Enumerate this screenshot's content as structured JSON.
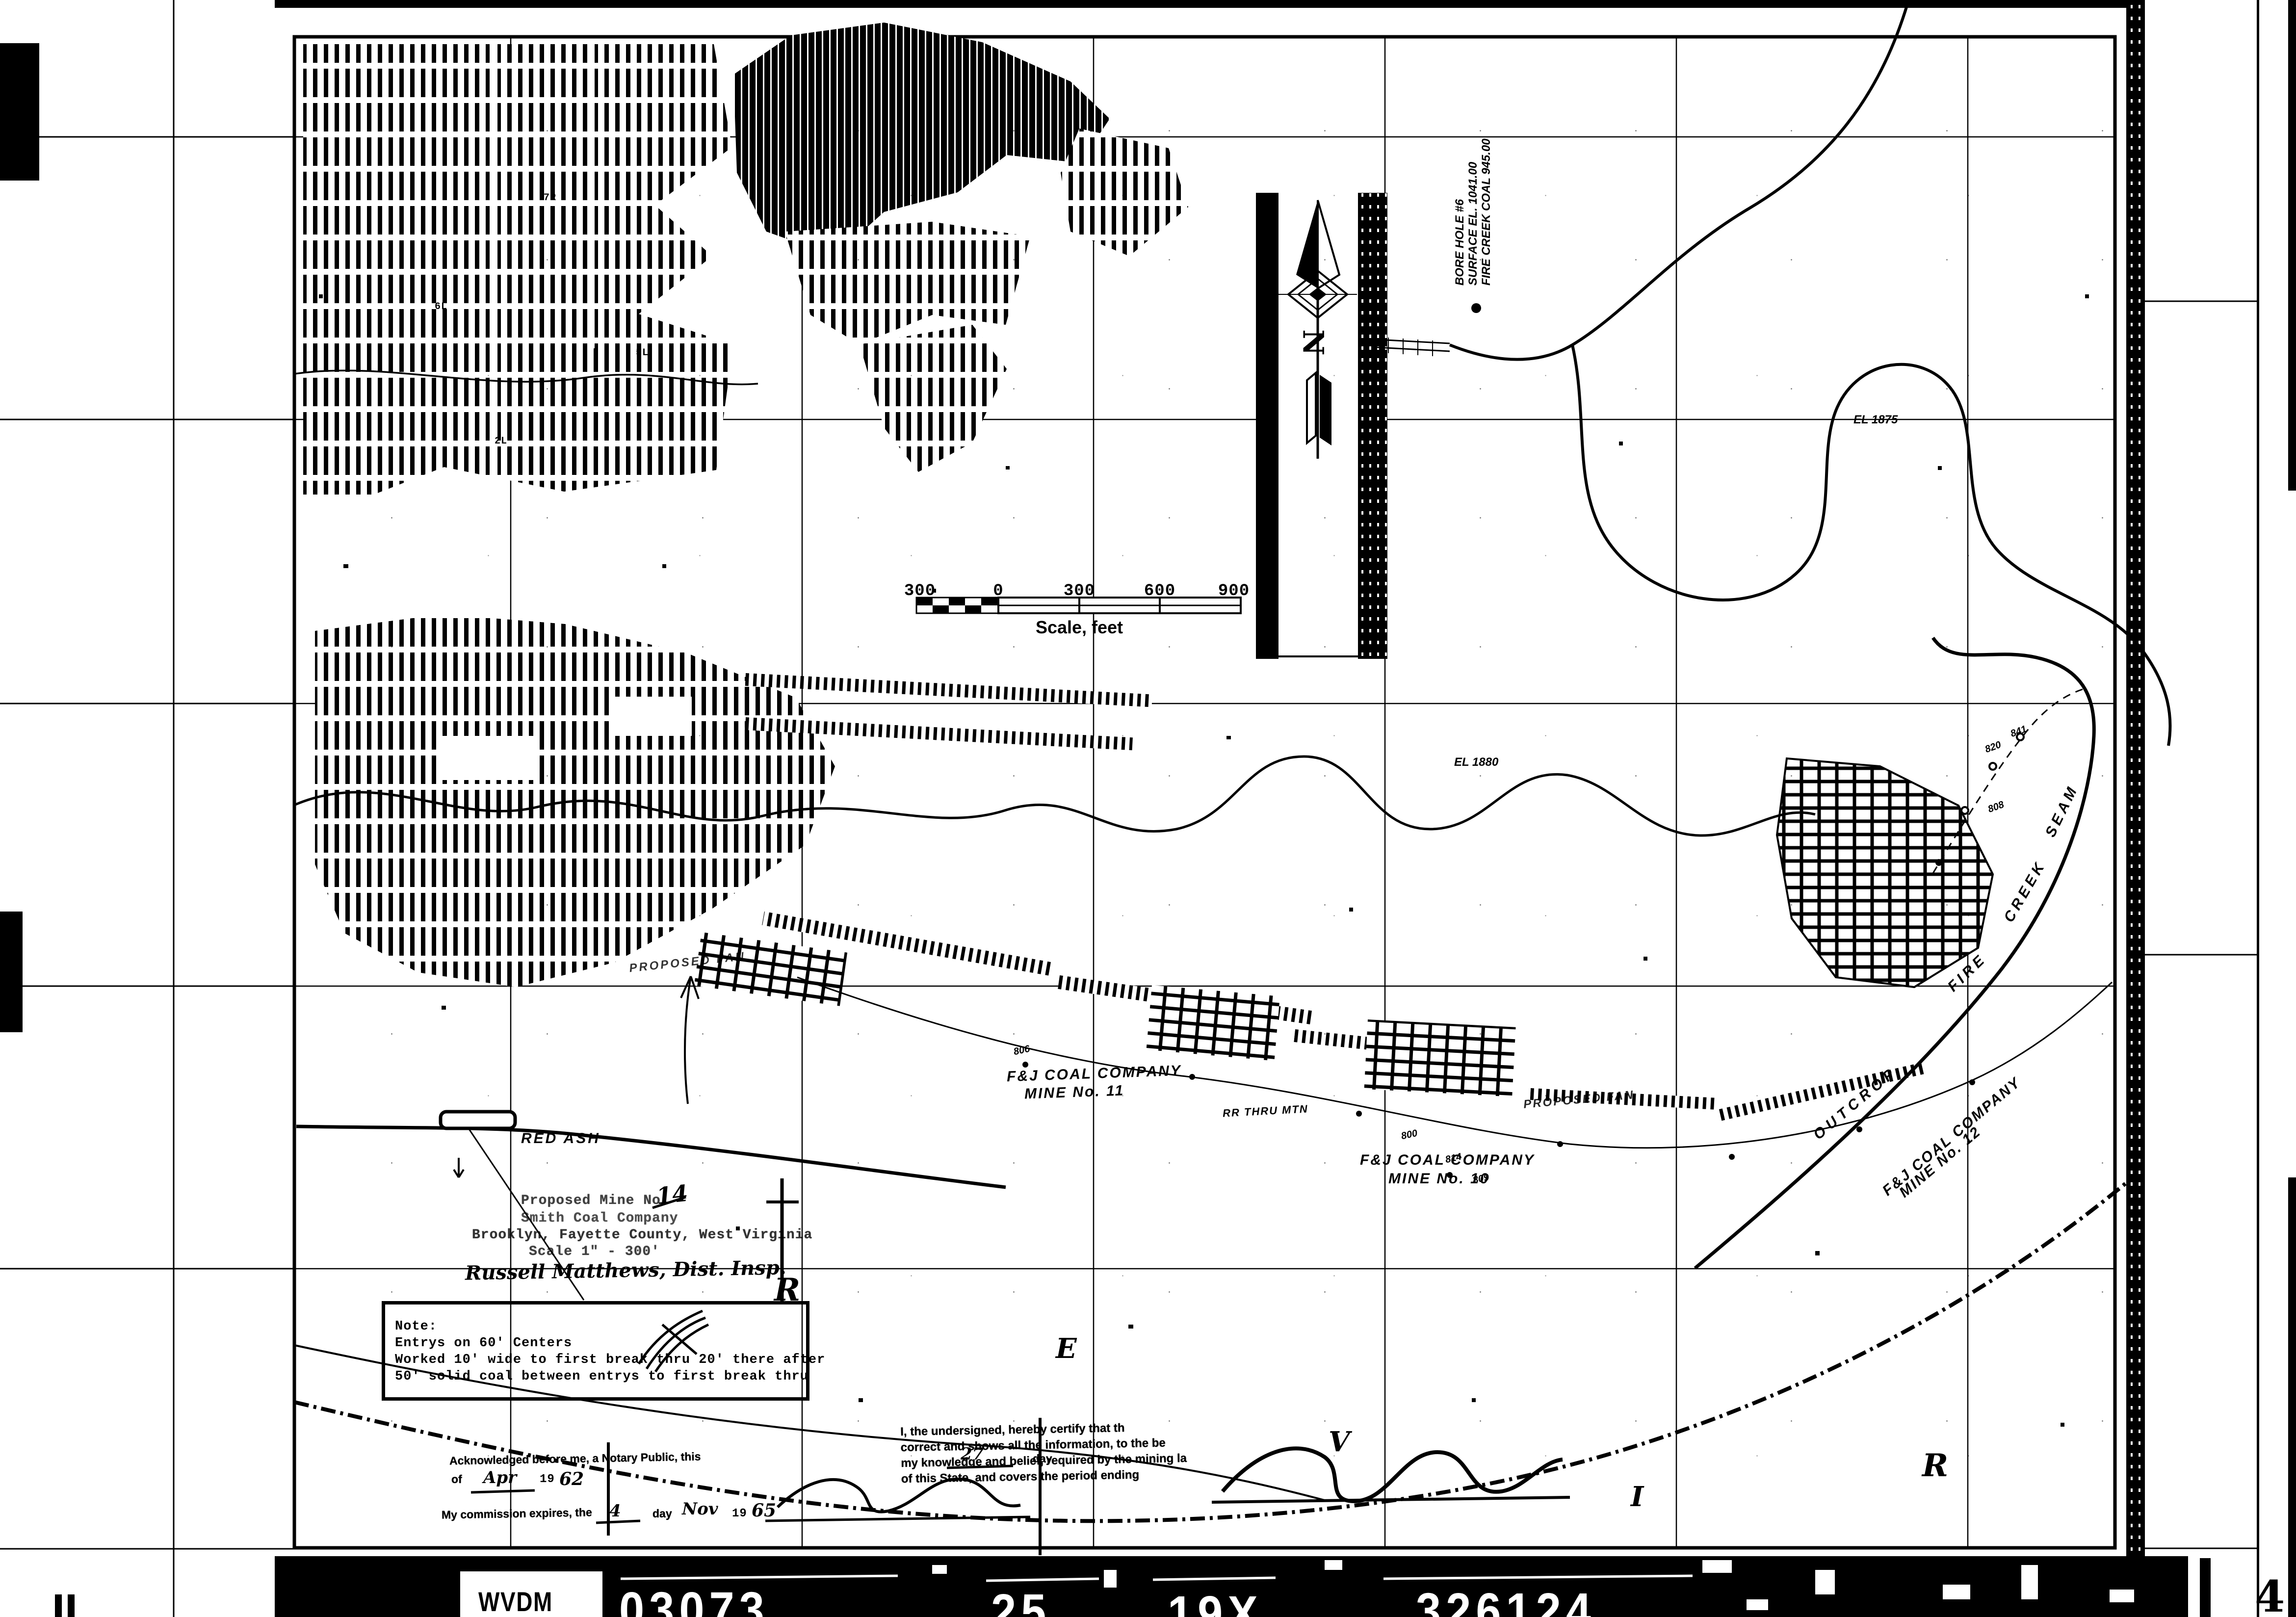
{
  "colors": {
    "ink": "#000000",
    "paper": "#ffffff"
  },
  "film_strip": {
    "agency": "WVDM",
    "codes": [
      "03073",
      "25",
      "19X",
      "326124"
    ]
  },
  "corner_marks": {
    "bottom_left": "II",
    "bottom_right": "4"
  },
  "north": {
    "label": "N"
  },
  "scale_bar": {
    "ticks": [
      "300",
      "0",
      "300",
      "600",
      "900"
    ],
    "caption": "Scale, feet"
  },
  "title_block": {
    "line1": "Proposed Mine No:",
    "mine_no": "14",
    "line2": "Smith Coal Company",
    "line3": "Brooklyn, Fayette County, West Virginia",
    "line4": "Scale 1\" - 300'",
    "inspector": "Russell Matthews, Dist. Insp."
  },
  "note_box": {
    "title": "Note:",
    "line1": "Entrys on 60' Centers",
    "line2": "Worked 10' wide to first break thru 20' there after",
    "line3": "50' solid coal between entrys to first break thru"
  },
  "certification": {
    "line1": "I, the undersigned, hereby certify that th",
    "line2": "correct and shows all the information, to the be",
    "line3": "my knowledge and belief, required by the mining la",
    "line4": "of this State, and covers the period ending"
  },
  "notary": {
    "ack": "Acknowledged before me, a Notary Public, this",
    "ack_day": "27",
    "day_word": "day",
    "of_word": "of",
    "ack_month": "Apr",
    "year_prefix": "19",
    "ack_year": "62",
    "exp": "My commission expires, the",
    "exp_day": "4",
    "exp_month": "Nov",
    "exp_year": "65"
  },
  "borehole": {
    "line1": "BORE HOLE #6",
    "line2": "SURFACE EL. 1041.00",
    "line3": "FIRE CREEK COAL 945.00"
  },
  "mines": {
    "mine11_company": "F&J COAL COMPANY",
    "mine11_no": "MINE No. 11",
    "mine10_company": "F&J COAL COMPANY",
    "mine10_no": "MINE No. 10",
    "mine12_company": "F&J COAL COMPANY",
    "mine12_no": "MINE No. 12"
  },
  "features": {
    "outcrop": "OUTCROP",
    "seam_fire": "FIRE",
    "seam_creek": "CREEK",
    "seam_seam": "SEAM",
    "red_ash": "RED ASH",
    "proposed_fan": "PROPOSED FAN",
    "rr": "RR THRU MTN"
  },
  "elevations": {
    "el1": "EL 1875",
    "el2": "EL 1880"
  },
  "stations": [
    "806",
    "800",
    "814",
    "809",
    "820",
    "841",
    "808"
  ],
  "river_letters": [
    "R",
    "E",
    "V",
    "I",
    "R"
  ],
  "entry_tags": [
    "7R",
    "6L",
    "5L",
    "2L"
  ]
}
